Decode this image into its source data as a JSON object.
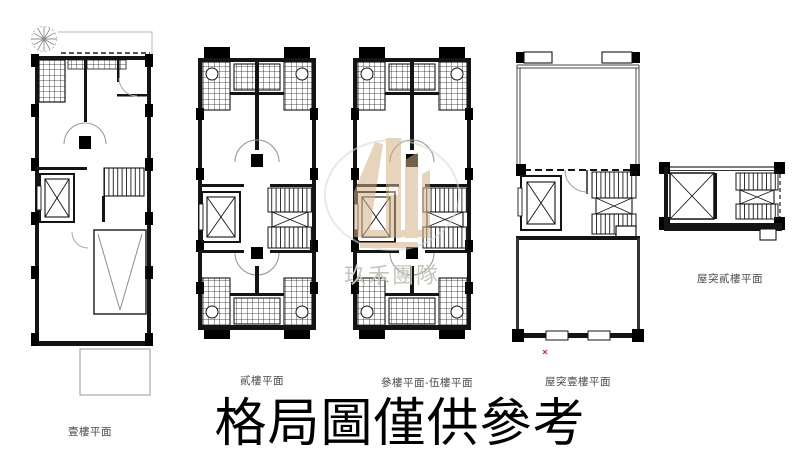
{
  "page": {
    "background": "#ffffff",
    "disclaimer": "格局圖僅供參考"
  },
  "plans": [
    {
      "name": "floor-1",
      "label": "壹樓平面"
    },
    {
      "name": "floor-2",
      "label": "貳樓平面"
    },
    {
      "name": "floor-3-5",
      "label": "參樓平面-伍樓平面"
    },
    {
      "name": "rooftop-1",
      "label": "屋突壹樓平面"
    },
    {
      "name": "rooftop-2",
      "label": "屋突貳樓平面"
    }
  ],
  "watermark": {
    "team_name": "玖禾團隊",
    "logo_color": "#d3b186",
    "text_color": "#c7c4bc"
  },
  "colors": {
    "plan_line": "#141414",
    "label_text": "#4a4a4a",
    "disclaimer_text": "#000000",
    "red_mark": "#c03030"
  }
}
